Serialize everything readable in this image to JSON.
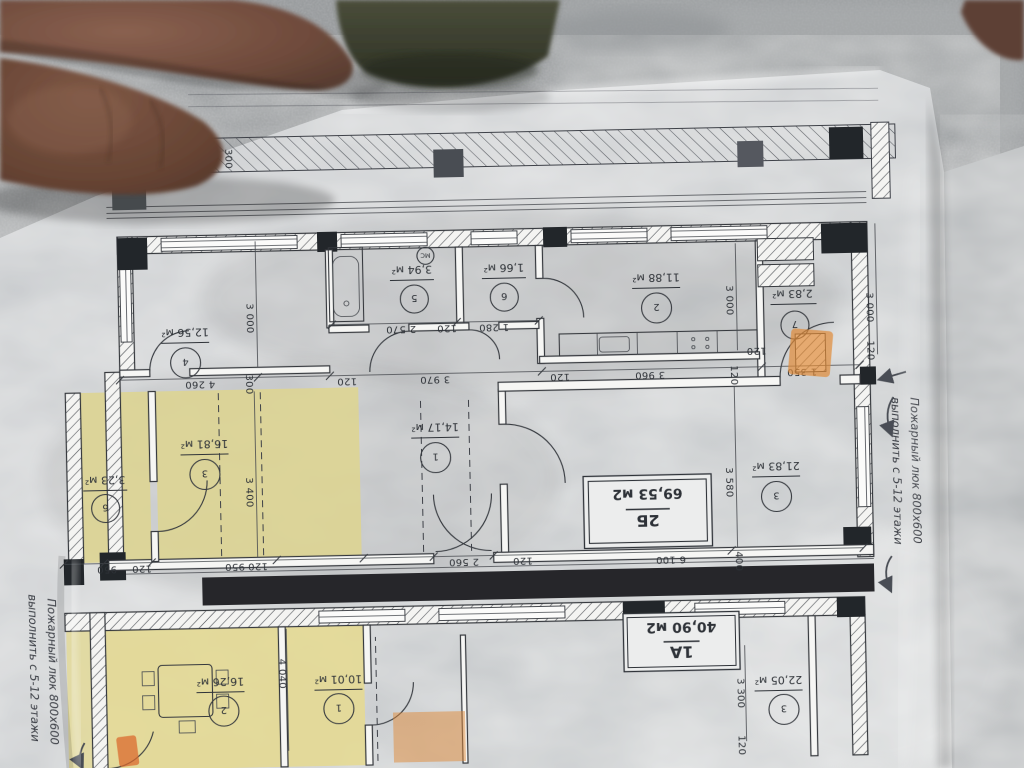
{
  "scene": {
    "description_labels": {},
    "colors": {
      "concrete": "#9a9d9f",
      "paper": "#cdd0d2",
      "ink": "#34383e",
      "room_yellow": "#ddd492",
      "room_yellow_warm": "#e4d995",
      "highlight_orange": "#e08a38",
      "skin_dark": "#6e4a3b"
    }
  },
  "plan": {
    "flats": {
      "b2": {
        "code": "2Б",
        "area": "69,53 м2"
      },
      "a1": {
        "code": "1А",
        "area": "40,90 м2"
      }
    },
    "note_right": {
      "line1": "Пожарный люк 800х600",
      "line2": "выполнить с 5-12 этажи"
    },
    "note_left": {
      "line1": "Пожарный люк 800х600",
      "line2": "выполнить с 5-12 этажи"
    },
    "appliance_label": "МС",
    "rooms_b2": [
      {
        "num": "1",
        "area": "14,17 м²"
      },
      {
        "num": "2",
        "area": "11,88 м²"
      },
      {
        "num": "3",
        "area": "21,83 м²"
      },
      {
        "num": "4",
        "area": "12,56 м²"
      },
      {
        "num": "5",
        "area": "3,94 м²"
      },
      {
        "num": "6",
        "area": "1,66 м²"
      },
      {
        "num": "7",
        "area": "2,83 м²"
      }
    ],
    "rooms_adjacent": [
      {
        "num": "3",
        "area": "16,81 м²"
      },
      {
        "num": "6",
        "area": "3,23 м²"
      }
    ],
    "rooms_a1": [
      {
        "num": "1",
        "area": "10,01 м²"
      },
      {
        "num": "2",
        "area": "16,26 м²"
      },
      {
        "num": "3",
        "area": "22,05 м²"
      }
    ],
    "dims": [
      "300",
      "1 350",
      "120",
      "3 960",
      "120",
      "3 970",
      "120",
      "300",
      "4 260",
      "120",
      "1 280",
      "120",
      "2 570",
      "3 000",
      "3 000",
      "3 580",
      "3 400",
      "3 000",
      "120",
      "400",
      "6 100",
      "120",
      "2 560",
      "120",
      "950",
      "120",
      "950",
      "4 040",
      "3 300",
      "120"
    ]
  }
}
